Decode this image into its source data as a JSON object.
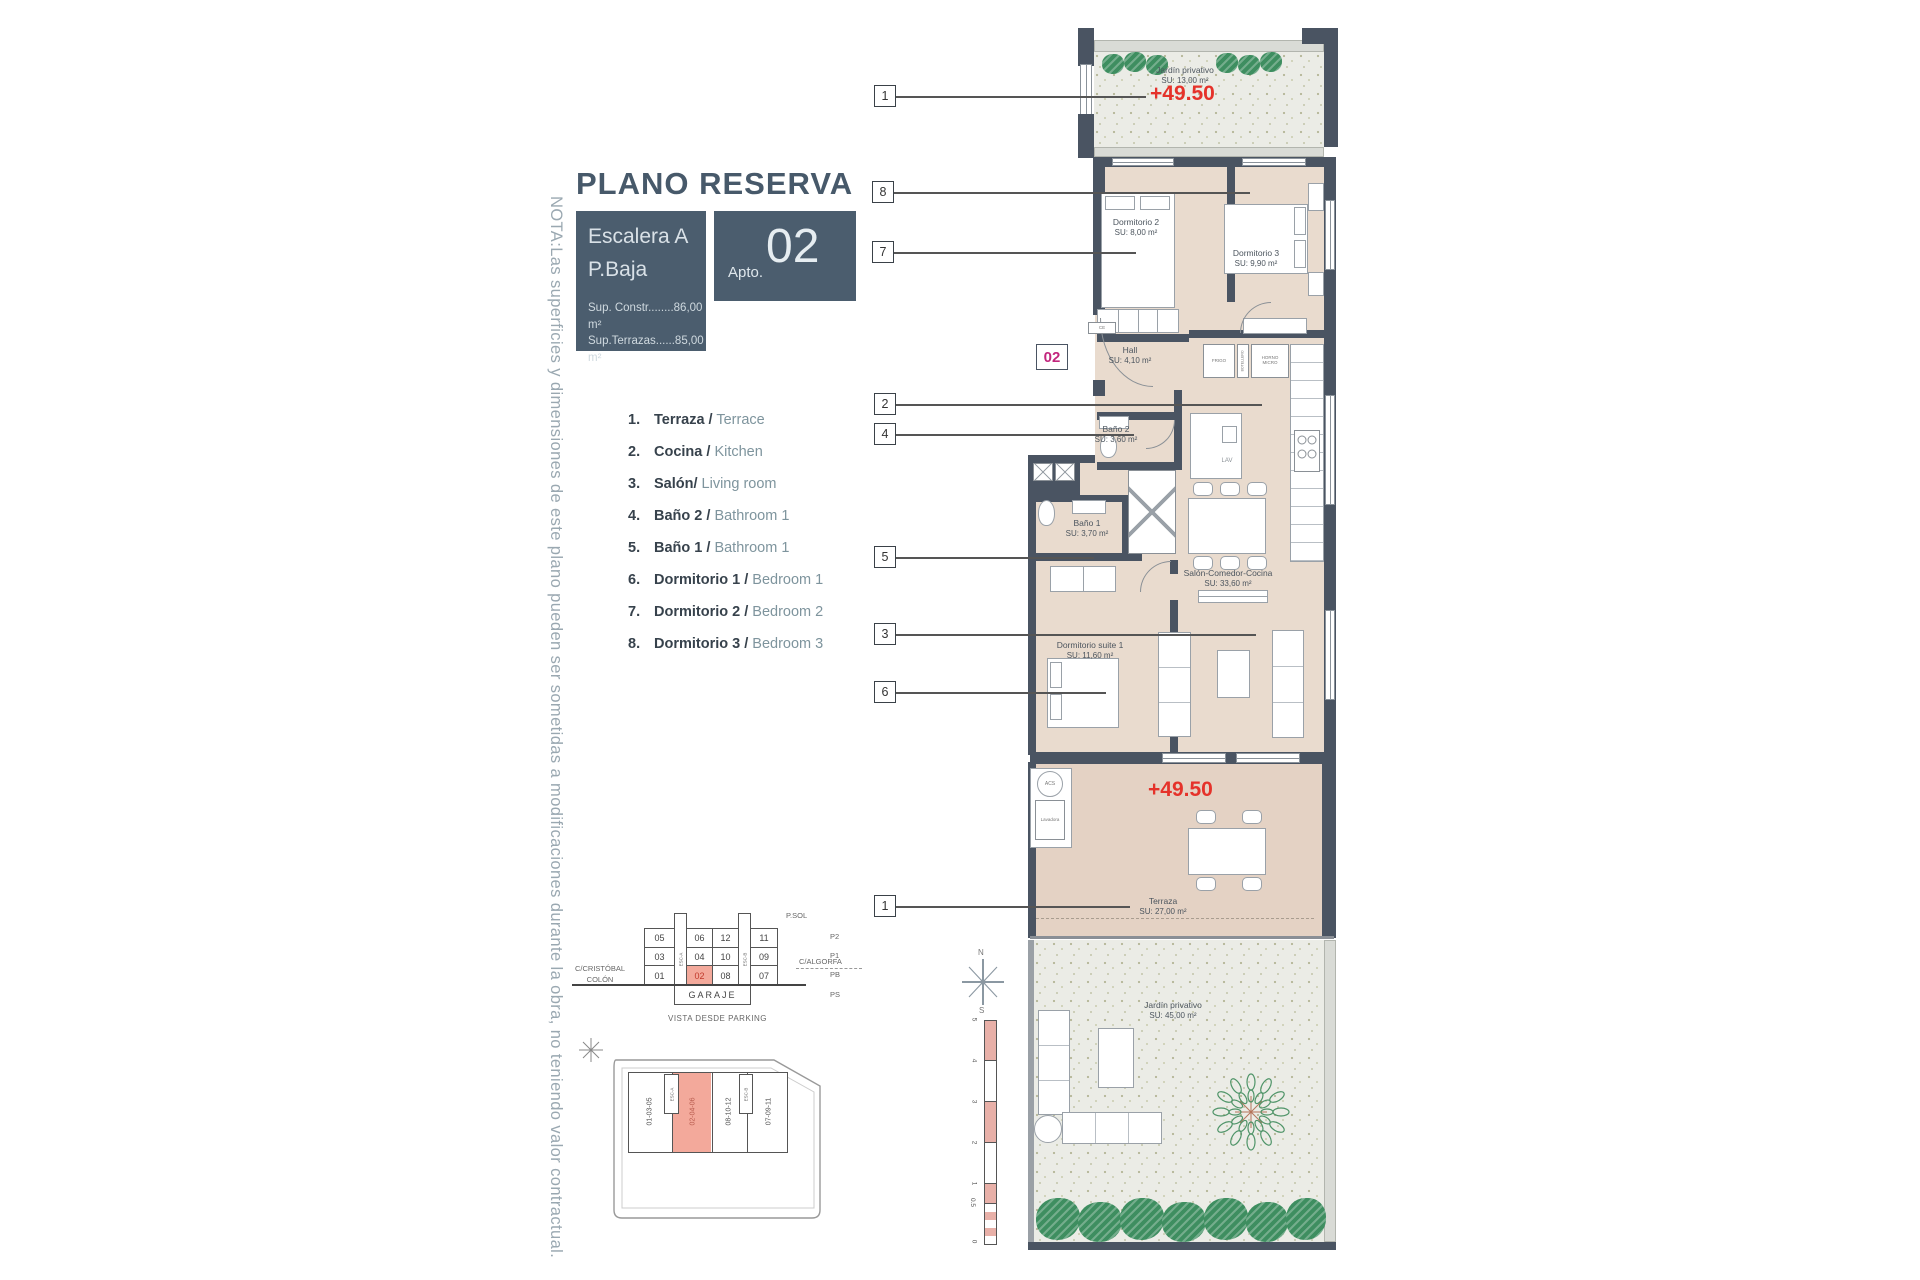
{
  "note": "NOTA:Las superficies y dimensiones de este plano pueden ser sometidas a modificaciones durante la obra, no teniendo valor contractual.",
  "title": "PLANO RESERVA",
  "titleblock": {
    "escalera": "Escalera A",
    "planta": "P.Baja",
    "apto_label": "Apto.",
    "apto_num": "02",
    "sup1": "Sup. Constr........86,00 m²",
    "sup2": "Sup.Terrazas......85,00 m²"
  },
  "legend": [
    {
      "num": "1.",
      "es": "Terraza /",
      "en": "Terrace"
    },
    {
      "num": "2.",
      "es": "Cocina /",
      "en": "Kitchen"
    },
    {
      "num": "3.",
      "es": "Salón/",
      "en": "Living room"
    },
    {
      "num": "4.",
      "es": "Baño 2 /",
      "en": "Bathroom 1"
    },
    {
      "num": "5.",
      "es": "Baño 1 /",
      "en": "Bathroom 1"
    },
    {
      "num": "6.",
      "es": "Dormitorio 1 /",
      "en": "Bedroom 1"
    },
    {
      "num": "7.",
      "es": "Dormitorio 2 /",
      "en": "Bedroom 2"
    },
    {
      "num": "8.",
      "es": "Dormitorio 3 /",
      "en": "Bedroom 3"
    }
  ],
  "plan": {
    "badge": "02",
    "level_top": "+49.50",
    "level_terrace": "+49.50",
    "garden_top": {
      "name": "Jardín privativo",
      "su": "SU: 13,00 m²"
    },
    "dorm2": {
      "name": "Dormitorio 2",
      "su": "SU: 8,00 m²"
    },
    "dorm3": {
      "name": "Dormitorio 3",
      "su": "SU: 9,90 m²"
    },
    "hall": {
      "name": "Hall",
      "su": "SU: 4,10 m²"
    },
    "bano2": {
      "name": "Baño 2",
      "su": "SU: 3,60 m²"
    },
    "bano1": {
      "name": "Baño 1",
      "su": "SU: 3,70 m²"
    },
    "salon": {
      "name": "Salón-Comedor-Cocina",
      "su": "SU: 33,60 m²"
    },
    "suite": {
      "name": "Dormitorio suite 1",
      "su": "SU: 11,60 m²"
    },
    "terraza": {
      "name": "Terraza",
      "su": "SU: 27,00 m²"
    },
    "garden_bottom": {
      "name": "Jardín privativo",
      "su": "SU: 45,00 m²"
    },
    "kitchen": {
      "frigo": "FRIGO",
      "botellero": "BOTELLERO",
      "horno_l1": "HORNO",
      "horno_l2": "MICRO",
      "lav": "LAV"
    },
    "labels": {
      "ce": "CE",
      "acs": "ACS",
      "lavadora": "Lavadora"
    },
    "callouts": [
      "1",
      "8",
      "7",
      "2",
      "4",
      "5",
      "3",
      "6",
      "1"
    ],
    "compass": {
      "n": "N",
      "s": "S"
    },
    "scale": [
      "5",
      "4",
      "3",
      "2",
      "1",
      "0.5",
      "0"
    ]
  },
  "parking": {
    "title_top": "P.SOL",
    "rows": [
      [
        "05",
        "06",
        "12",
        "11"
      ],
      [
        "03",
        "04",
        "10",
        "09"
      ],
      [
        "01",
        "02",
        "08",
        "07"
      ]
    ],
    "garage": "GARAJE",
    "levels": [
      "P2",
      "P1",
      "PB",
      "PS"
    ],
    "esc_left": "ESC-A",
    "esc_right": "ESC-B",
    "street_left1": "C/CRISTÓBAL",
    "street_left2": "COLÓN",
    "street_right": "C/ALGORFA",
    "caption": "VISTA DESDE PARKING"
  },
  "siteplan": {
    "blocks": [
      "01-03-05",
      "02-04-06",
      "08-10-12",
      "07-09-11"
    ],
    "esc_a": "ESC-A",
    "esc_b": "ESC-B"
  }
}
